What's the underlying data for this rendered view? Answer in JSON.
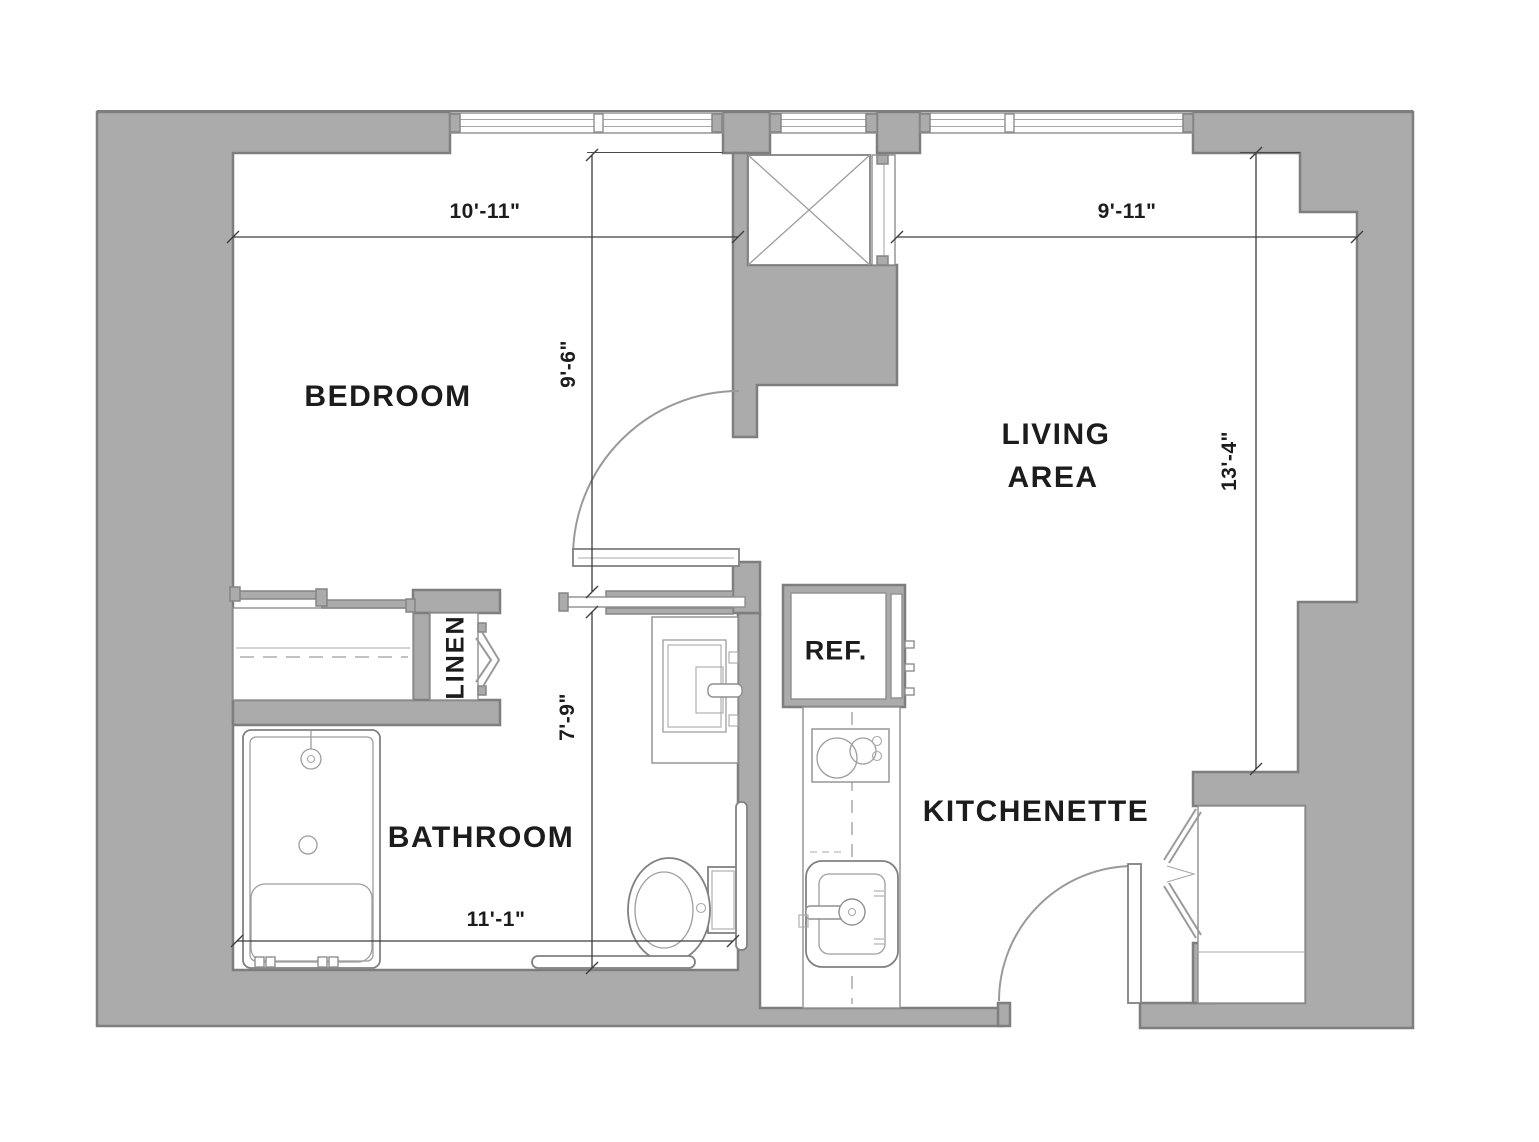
{
  "rooms": {
    "bedroom": {
      "label": "BEDROOM"
    },
    "living_area": {
      "label_line1": "LIVING",
      "label_line2": "AREA"
    },
    "bathroom": {
      "label": "BATHROOM"
    },
    "kitchenette": {
      "label": "KITCHENETTE"
    }
  },
  "fixtures": {
    "refrigerator_label": "REF.",
    "linen_closet_label": "LINEN"
  },
  "dimensions": {
    "bedroom_width": "10'-11\"",
    "living_width": "9'-11\"",
    "bedroom_depth": "9'-6\"",
    "living_depth": "13'-4\"",
    "bath_hall_depth": "7'-9\"",
    "bathroom_width": "11'-1\""
  },
  "colors": {
    "wall_fill": "#ababab",
    "wall_outline": "#7e7e7e",
    "fixture_line": "#9a9a9a",
    "text": "#1c1c1c",
    "background": "#ffffff"
  }
}
